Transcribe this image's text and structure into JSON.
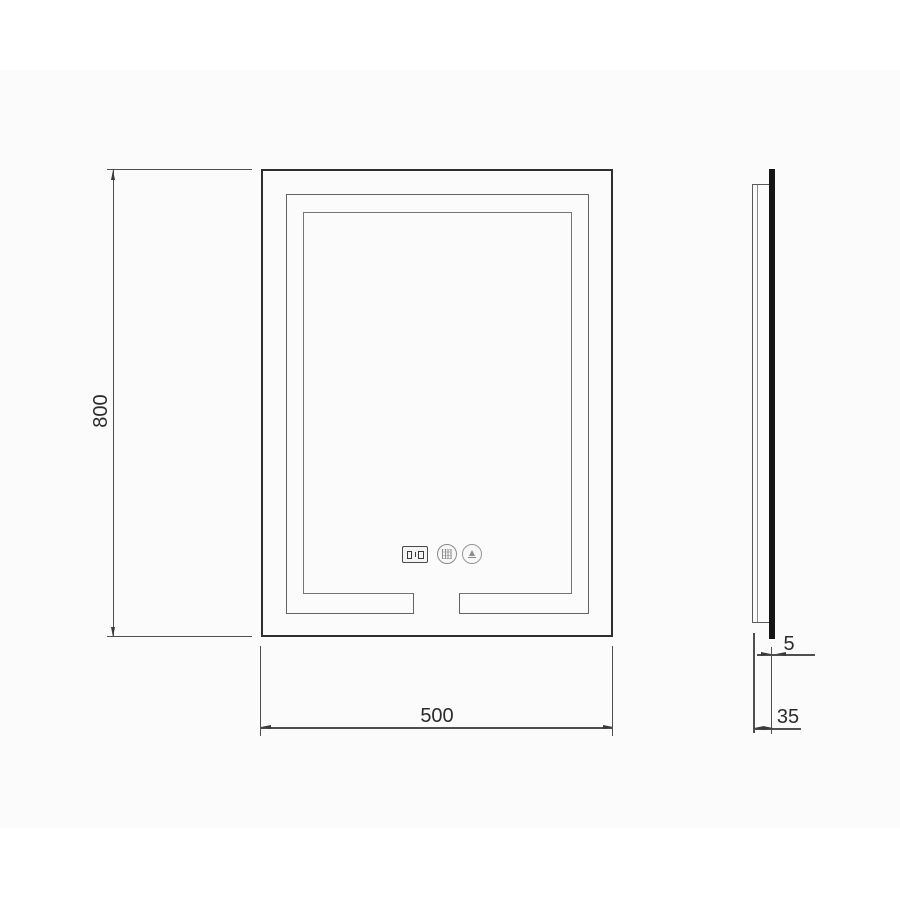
{
  "drawing": {
    "type": "technical-dimension-drawing",
    "subject": "illuminated-led-mirror",
    "front_view": {
      "dim_height": "800",
      "dim_width": "500",
      "controls": {
        "icons": [
          "time-temperature-display-icon",
          "defogger-touch-button-icon",
          "light-touch-button-icon"
        ]
      }
    },
    "side_view": {
      "dim_glass_thickness": "5",
      "dim_depth": "35"
    },
    "colors": {
      "background": "#ffffff",
      "panel_background": "#fbfbfb",
      "outline_dark": "#2e2e2e",
      "outline_mid": "#636363",
      "outline_light": "#757575",
      "dimension_line": "#4f4f4f",
      "glass_fill": "#141414",
      "text": "#2b2b2b"
    }
  }
}
